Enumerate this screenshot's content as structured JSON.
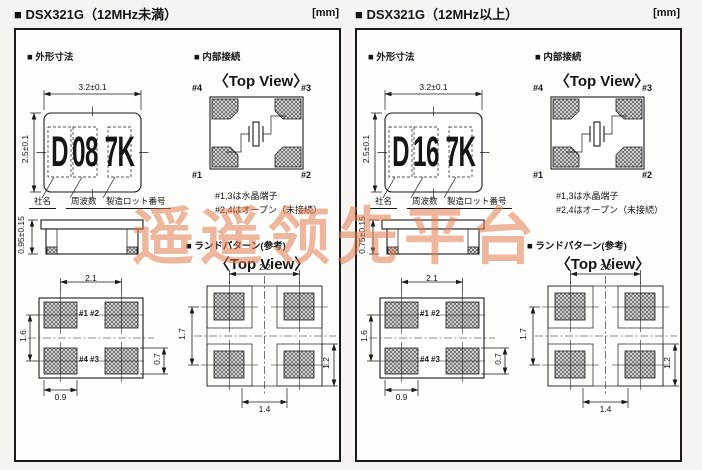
{
  "watermark": "遥遥领先平台",
  "panels": [
    {
      "header": "■ DSX321G（12MHz未満）",
      "unit": "[mm]",
      "outline": {
        "title": "■ 外形寸法",
        "dim_width": "3.2±0.1",
        "dim_height": "2.5±0.1",
        "dim_thickness": "0.95±0.15",
        "marking": [
          "D",
          "08",
          "7K"
        ],
        "marking_labels": [
          "社名",
          "周波数",
          "製造ロット番号"
        ],
        "bottom_view": {
          "dim_pitch_x": "2.1",
          "dim_pitch_y": "1.6",
          "dim_pad_width": "0.9",
          "dim_pad_height": "0.7",
          "pad_top_left": "#1",
          "pad_top_right": "#2",
          "pad_bottom_left": "#4",
          "pad_bottom_right": "#3"
        }
      },
      "internal": {
        "title": "■ 内部接続",
        "view_label": "〈Top View〉",
        "pin_top_left": "#4",
        "pin_top_right": "#3",
        "pin_bottom_left": "#1",
        "pin_bottom_right": "#2",
        "notes": [
          "#1,3は水晶端子",
          "#2,4はオープン（未接続）"
        ]
      },
      "land": {
        "title": "■ ランドパターン(参考)",
        "view_label": "〈Top View〉",
        "dim_width": "2.2",
        "dim_height": "1.7",
        "dim_span_x": "1.4",
        "dim_span_y": "1.2"
      }
    },
    {
      "header": "■ DSX321G（12MHz以上）",
      "unit": "[mm]",
      "outline": {
        "title": "■ 外形寸法",
        "dim_width": "3.2±0.1",
        "dim_height": "2.5±0.1",
        "dim_thickness": "0.75±0.15",
        "marking": [
          "D",
          "16",
          "7K"
        ],
        "marking_labels": [
          "社名",
          "周波数",
          "製造ロット番号"
        ],
        "bottom_view": {
          "dim_pitch_x": "2.1",
          "dim_pitch_y": "1.6",
          "dim_pad_width": "0.9",
          "dim_pad_height": "0.7",
          "pad_top_left": "#1",
          "pad_top_right": "#2",
          "pad_bottom_left": "#4",
          "pad_bottom_right": "#3"
        }
      },
      "internal": {
        "title": "■ 内部接続",
        "view_label": "〈Top View〉",
        "pin_top_left": "#4",
        "pin_top_right": "#3",
        "pin_bottom_left": "#1",
        "pin_bottom_right": "#2",
        "notes": [
          "#1,3は水晶端子",
          "#2,4はオープン（未接続）"
        ]
      },
      "land": {
        "title": "■ ランドパターン(参考)",
        "view_label": "〈Top View〉",
        "dim_width": "2.2",
        "dim_height": "1.7",
        "dim_span_x": "1.4",
        "dim_span_y": "1.2"
      }
    }
  ]
}
